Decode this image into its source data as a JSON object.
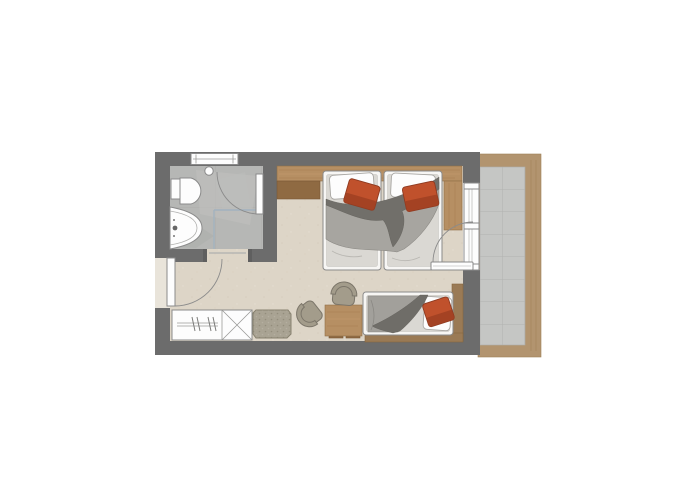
{
  "scene": {
    "label": "Hotel room floor plan",
    "rooms": [
      "bathroom",
      "bedroom",
      "entry-hall",
      "balcony"
    ],
    "fixtures": [
      "toilet",
      "washbasin",
      "shower",
      "ceiling-light",
      "bathroom-window"
    ],
    "furniture": [
      "twin-bed-1",
      "twin-bed-2",
      "daybed",
      "desk",
      "desk-chair",
      "lounge-chair",
      "bench",
      "wardrobe",
      "storage-cabinet",
      "headboard-shelf",
      "nightstand",
      "window-side-shelf"
    ],
    "doors": [
      "entrance-door",
      "bathroom-sliding-door",
      "shower-door",
      "balcony-door"
    ],
    "accents": [
      "orange-accent-pillows",
      "gray-duvets"
    ]
  },
  "colors": {
    "bg": "#ffffff",
    "wall": "#6c6c6c",
    "roomFloor": "#ddd5c7",
    "bathFloor": "#b6b7b5",
    "bathTileLine": "#a9aaa8",
    "balconyTile": "#c5c6c4",
    "balconyTileLine": "#b1b2b0",
    "balconyWood": "#b2946f",
    "wood1": "#b68f63",
    "wood2": "#8f6a42",
    "wood3": "#9a7a55",
    "mattress": "#dad8d3",
    "bedWhite": "#f7f6f4",
    "duvet": "#a7a5a0",
    "duvetDark": "#716f6a",
    "blanket": "#a2a09b",
    "blanketDark": "#6f6d68",
    "orange": "#c0512c",
    "orangeDark": "#9c3e22",
    "fabric": "#a39c8b",
    "fabricDark": "#7c766a",
    "benchFabric": "#a9a393",
    "glass": "#a2b2bf",
    "outline": "#8a8a8a",
    "white": "#fdfdfd"
  }
}
